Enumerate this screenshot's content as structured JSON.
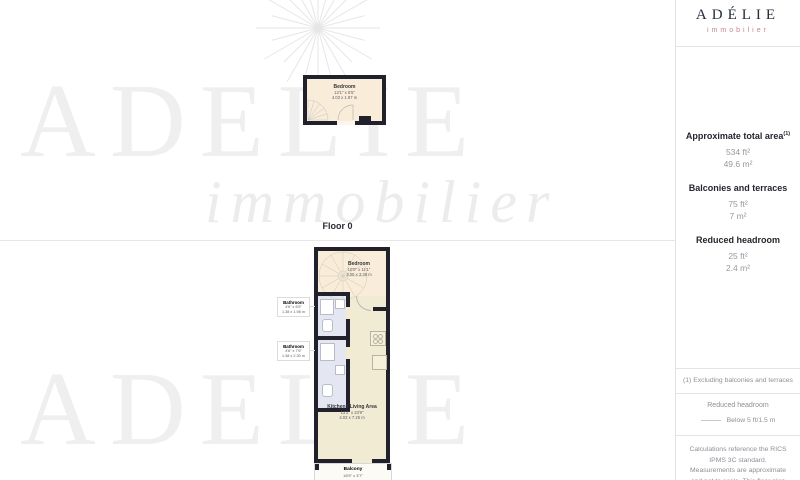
{
  "branding": {
    "logo": "ADÉLIE",
    "logo_sub": "immobilier"
  },
  "watermark": {
    "line1": "ADELIE",
    "line2": "immobilier",
    "line3": "ADELIE"
  },
  "floor0": {
    "label": "Floor 0",
    "bedroom": {
      "name": "Bedroom",
      "ft": "13'1\" x 6'5\"",
      "m": "4.03 x 1.97 m"
    }
  },
  "floor1": {
    "bedroom": {
      "name": "Bedroom",
      "ft": "10'0\" x 11'1\"",
      "m": "3.05 x 3.39 m"
    },
    "bathroom1": {
      "name": "Bathroom",
      "ft": "4'6\" x 6'5\"",
      "m": "1.38 x 1.98 m"
    },
    "bathroom2": {
      "name": "Bathroom",
      "ft": "4'6\" x 7'6\"",
      "m": "1.38 x 2.30 m"
    },
    "kitchen": {
      "name": "Kitchen / Living Area",
      "ft": "13'2\" x 23'9\"",
      "m": "4.03 x 7.25 m"
    },
    "balcony": {
      "name": "Balcony",
      "ft": "18'5\" x 3'7\""
    }
  },
  "sidebar": {
    "total": {
      "title": "Approximate total area",
      "sup": "(1)",
      "ft": "534 ft²",
      "m": "49.6 m²"
    },
    "balconies": {
      "title": "Balconies and terraces",
      "ft": "75 ft²",
      "m": "7 m²"
    },
    "headroom": {
      "title": "Reduced headroom",
      "ft": "25 ft²",
      "m": "2.4 m²"
    },
    "footnote": "(1) Excluding balconies and terraces",
    "legend": {
      "title": "Reduced headroom",
      "label": "Below 5 ft/1.5 m"
    },
    "disclaimer": "Calculations reference the RICS IPMS 3C standard. Measurements are approximate and not to scale. This floor plan is intended for illustration"
  },
  "colors": {
    "wall": "#21212b",
    "bedroom_fill": "#f9ecd8",
    "living_fill": "#f1ebd3",
    "bathroom_fill": "#e4e6f1",
    "logo_navy": "#252c38",
    "logo_pink": "#c9858d"
  }
}
